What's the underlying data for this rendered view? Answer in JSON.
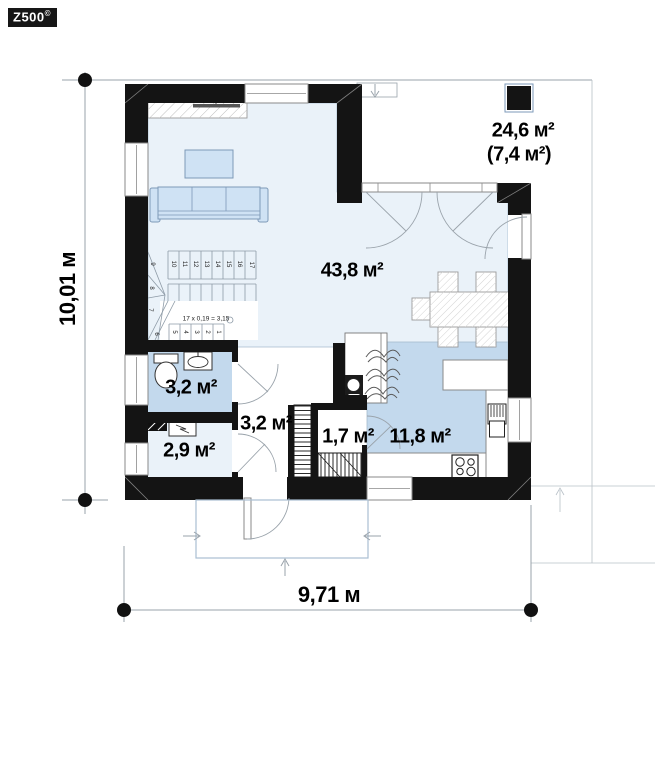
{
  "watermark": {
    "brand": "Z500",
    "symbol": "©"
  },
  "labels": {
    "terrace_main": "24,6 м²",
    "terrace_secondary": "(7,4 м²)",
    "living": "43,8 м²",
    "bathroom": "3,2 м²",
    "hall": "3,2 м²",
    "utility": "2,9 м²",
    "pantry": "1,7 м²",
    "kitchen": "11,8 м²"
  },
  "dimensions": {
    "height": "10,01 м",
    "width": "9,71 м"
  },
  "stairs": {
    "formula": "17 x 0,19 = 3,15",
    "numbers": [
      "1",
      "2",
      "3",
      "4",
      "5",
      "6",
      "7",
      "8",
      "9",
      "10",
      "11",
      "12",
      "13",
      "14",
      "15",
      "16",
      "17"
    ]
  },
  "colors": {
    "wall": "#141414",
    "room-light": "#eaf2f9",
    "room-medium": "#c3d9ed",
    "furniture": "#cfe2f4",
    "furniture-border": "#7e99b7",
    "porch": "#a9bfd3"
  }
}
